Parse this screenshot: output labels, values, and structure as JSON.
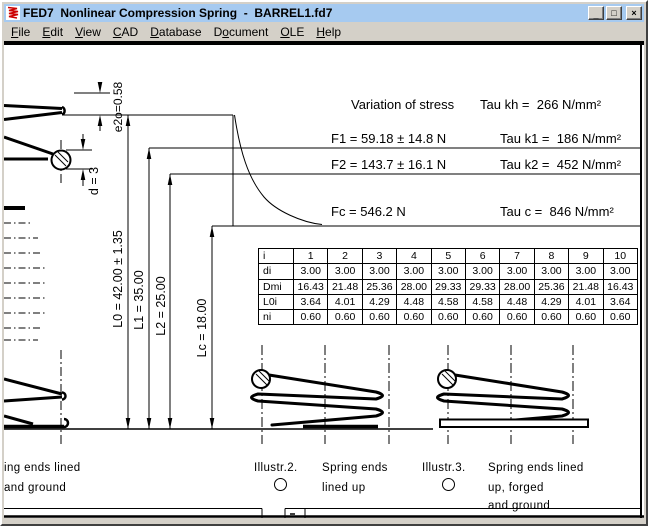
{
  "window": {
    "title": "FED7  Nonlinear Compression Spring  -  BARREL1.fd7",
    "buttons": {
      "minimize": "_",
      "maximize": "□",
      "close": "×"
    }
  },
  "menu": {
    "items": [
      {
        "label": "File",
        "underline": 0
      },
      {
        "label": "Edit",
        "underline": 0
      },
      {
        "label": "View",
        "underline": 0
      },
      {
        "label": "CAD",
        "underline": 0
      },
      {
        "label": "Database",
        "underline": 0
      },
      {
        "label": "Document",
        "underline": 1
      },
      {
        "label": "OLE",
        "underline": 0
      },
      {
        "label": "Help",
        "underline": 0
      }
    ]
  },
  "drawing": {
    "stress": {
      "variation_label": "Variation of stress",
      "tau_kh": "Tau kh =  266 N/mm²",
      "rows": [
        {
          "force": "F1 = 59.18 ± 14.8 N",
          "tau": "Tau k1 =  186 N/mm²"
        },
        {
          "force": "F2 = 143.7 ± 16.1 N",
          "tau": "Tau k2 =  452 N/mm²"
        },
        {
          "force": "Fc = 546.2 N",
          "tau": "Tau c =  846 N/mm²"
        }
      ]
    },
    "dimensions": {
      "e2o": "e2o=0.58",
      "d": "d = 3",
      "L0": "L0 = 42.00 ± 1.35",
      "L1": "L1 = 35.00",
      "L2": "L2 = 25.00",
      "Lc": "Lc = 18.00"
    },
    "coil_table": {
      "header_label": "i",
      "columns": [
        "1",
        "2",
        "3",
        "4",
        "5",
        "6",
        "7",
        "8",
        "9",
        "10"
      ],
      "rows": [
        {
          "label": "di",
          "values": [
            "3.00",
            "3.00",
            "3.00",
            "3.00",
            "3.00",
            "3.00",
            "3.00",
            "3.00",
            "3.00",
            "3.00"
          ]
        },
        {
          "label": "Dmi",
          "values": [
            "16.43",
            "21.48",
            "25.36",
            "28.00",
            "29.33",
            "29.33",
            "28.00",
            "25.36",
            "21.48",
            "16.43"
          ]
        },
        {
          "label": "L0i",
          "values": [
            "3.64",
            "4.01",
            "4.29",
            "4.48",
            "4.58",
            "4.58",
            "4.48",
            "4.29",
            "4.01",
            "3.64"
          ]
        },
        {
          "label": "ni",
          "values": [
            "0.60",
            "0.60",
            "0.60",
            "0.60",
            "0.60",
            "0.60",
            "0.60",
            "0.60",
            "0.60",
            "0.60"
          ]
        }
      ]
    },
    "captions": {
      "left_caption": [
        "ing ends lined",
        "and ground"
      ],
      "illustr2": "Illustr.2.",
      "spring2": [
        "Spring ends",
        "lined up"
      ],
      "illustr3": "Illustr.3.",
      "spring3": [
        "Spring ends lined",
        "up, forged",
        "and ground"
      ]
    }
  },
  "colors": {
    "titlebar": "#a6caf0",
    "chrome": "#d4d0c8",
    "line": "#000000"
  }
}
